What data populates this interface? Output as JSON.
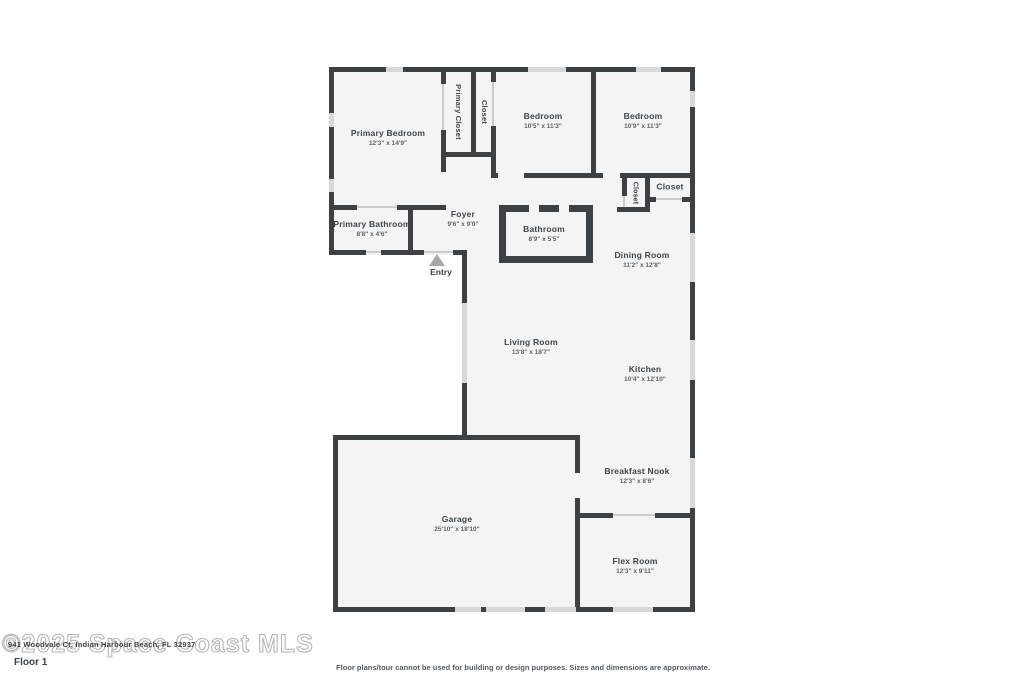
{
  "watermark_text": "©2025 Space Coast MLS",
  "address_text": "941 Woodvale Ct, Indian Harbour Beach, FL 32937",
  "floor_label": "Floor 1",
  "disclaimer": "Floor plans/tour cannot be used for building or design purposes. Sizes and dimensions are approximate.",
  "entry": {
    "label": "Entry"
  },
  "rooms": [
    {
      "name": "Primary Bedroom",
      "dims": "12'3\" x 14'9\""
    },
    {
      "name": "Primary Closet",
      "dims": ""
    },
    {
      "name": "Closet",
      "dims": ""
    },
    {
      "name": "Bedroom",
      "dims": "10'5\" x 11'3\""
    },
    {
      "name": "Bedroom",
      "dims": "10'9\" x 11'3\""
    },
    {
      "name": "Closet",
      "dims": ""
    },
    {
      "name": "Closet",
      "dims": ""
    },
    {
      "name": "Primary Bathroom",
      "dims": "8'8\" x 4'6\""
    },
    {
      "name": "Foyer",
      "dims": "9'6\" x 9'0\""
    },
    {
      "name": "Bathroom",
      "dims": "8'9\" x 5'5\""
    },
    {
      "name": "Dining Room",
      "dims": "11'2\" x 12'8\""
    },
    {
      "name": "Living Room",
      "dims": "13'8\" x 18'7\""
    },
    {
      "name": "Kitchen",
      "dims": "10'4\" x 12'10\""
    },
    {
      "name": "Breakfast Nook",
      "dims": "12'3\" x 8'6\""
    },
    {
      "name": "Garage",
      "dims": "25'10\" x 18'10\""
    },
    {
      "name": "Flex Room",
      "dims": "12'3\" x 9'11\""
    }
  ],
  "colors": {
    "wall": "#3d4144",
    "room_fill": "#f4f4f4",
    "window": "#d8d8d8",
    "door_line": "#cccccc",
    "label_text": "#3d4449",
    "watermark_outline": "#b3b3b3",
    "entry_arrow": "#a8a8a8"
  }
}
